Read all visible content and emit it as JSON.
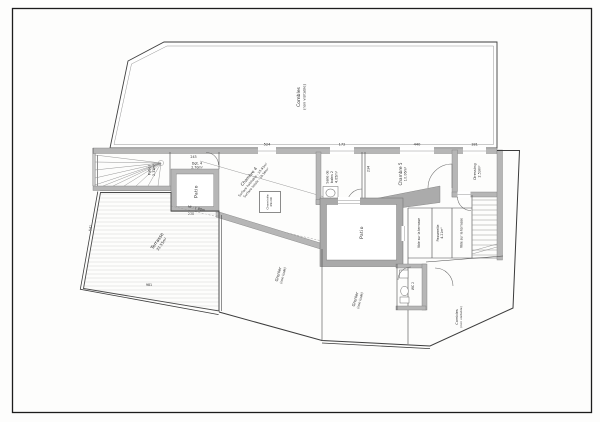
{
  "sheet": {
    "type_of_drawing": "floor-plan",
    "paper_color": "#fdfdfc",
    "line_color": "#4a4a4a",
    "wall_color": "#b6b6b6"
  },
  "labels": {
    "combles_top": {
      "name": "Combles",
      "note": "(non visitable)"
    },
    "palier": {
      "name": "Palier",
      "area": "2.31m²"
    },
    "dgt": {
      "name": "Dgt. 4",
      "area": "2.70m²"
    },
    "patio_left": {
      "name": "Patio"
    },
    "chambre4": {
      "name": "Chambre 4",
      "line2": "Surface habitable : 15.93m²",
      "line3": "Surface totale : 19.56m²"
    },
    "cheminee": {
      "name": "Cheminée",
      "size": "49x49"
    },
    "ht": {
      "text": "Ht : 1.80m"
    },
    "sdb2": {
      "l1": "Salle de",
      "l2": "bains 2",
      "area": "4.05m²"
    },
    "chambre5": {
      "name": "Chambre 5",
      "area": "10.06m²"
    },
    "dressing": {
      "name": "Dressing",
      "area": "2.53m²"
    },
    "vide": {
      "text": "Vide sur la terrasse"
    },
    "passerelle": {
      "name": "Passerelle",
      "area": "4.21m²"
    },
    "patio_center": {
      "name": "Patio"
    },
    "terrasse": {
      "name": "Terrasse",
      "area": "33.55m²"
    },
    "grenier": {
      "name": "Grenier",
      "note": "(non isolé)"
    },
    "wc": {
      "name": "WC 2"
    },
    "combles_br": {
      "name": "Combles",
      "note": "(non visitable)"
    }
  },
  "dimensions": {
    "d524": "524",
    "d172": "172",
    "d440": "440",
    "d181": "181",
    "d243": "243",
    "d238": "238",
    "d234": "234",
    "d981": "981",
    "d541": "541"
  }
}
